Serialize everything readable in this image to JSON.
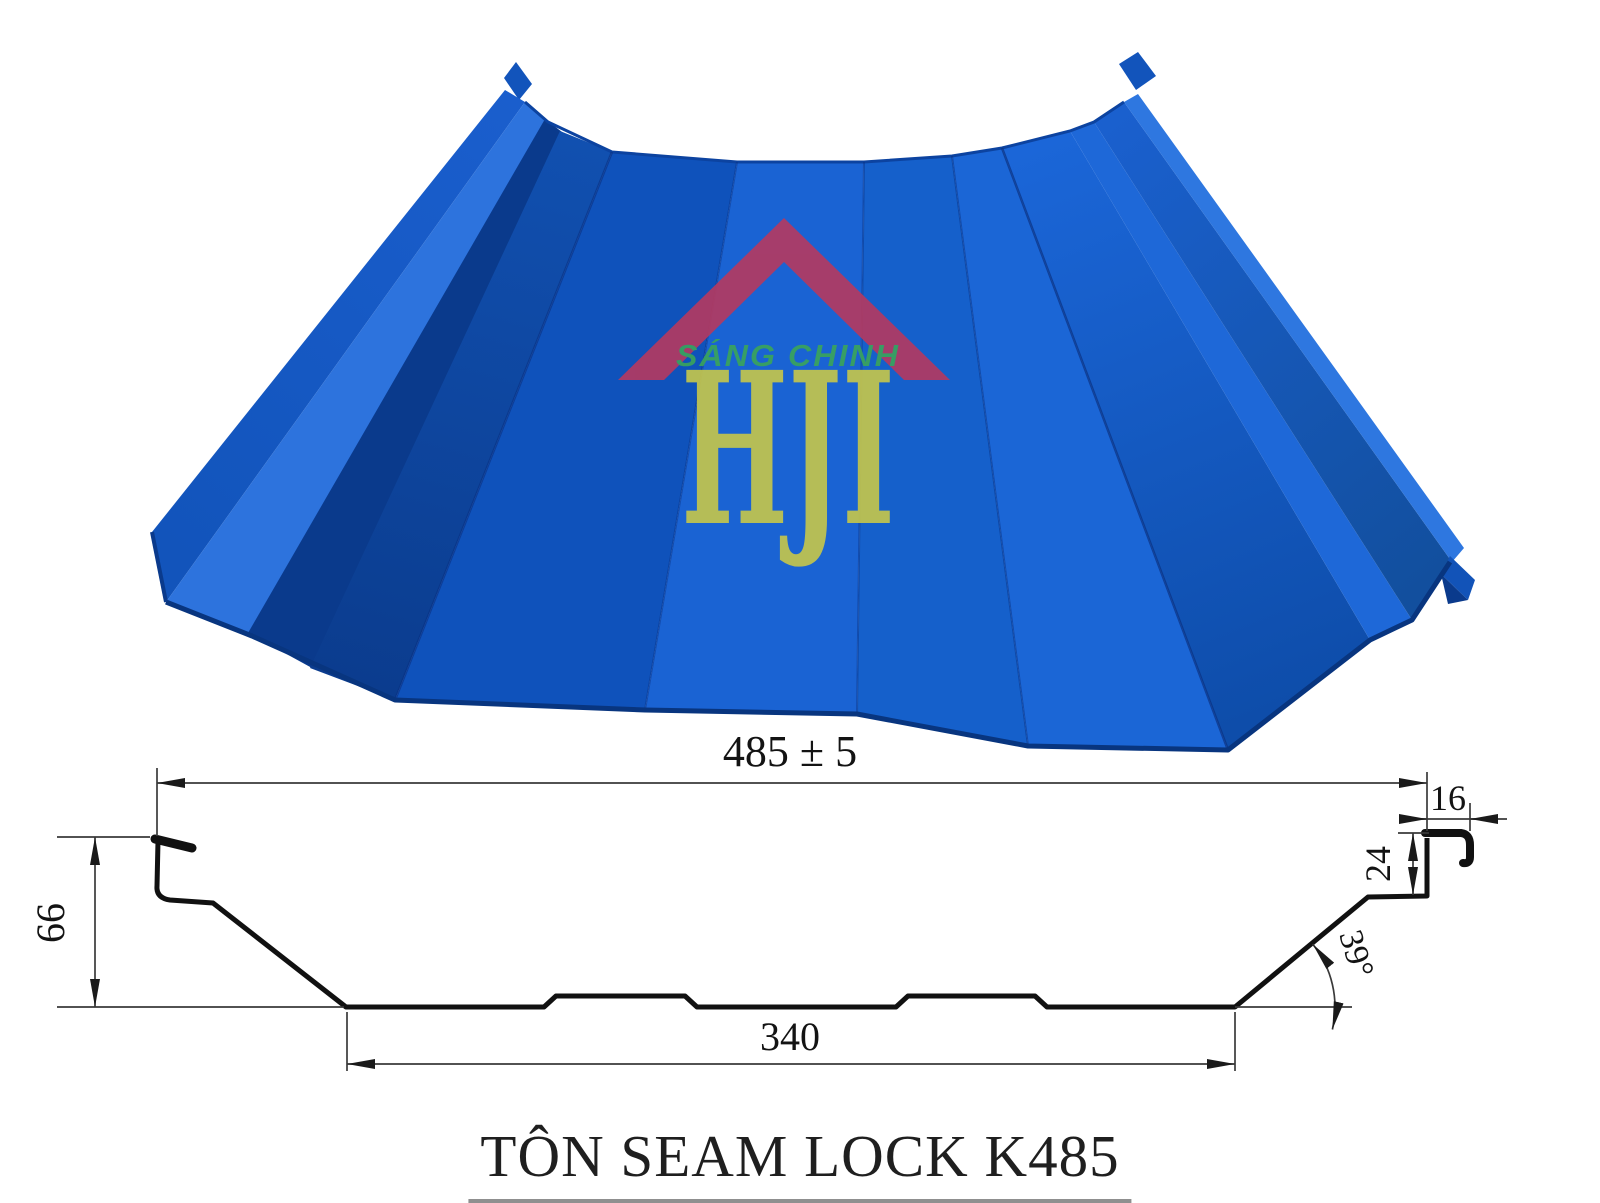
{
  "product": {
    "title": "TÔN SEAM LOCK K485",
    "type": "standing-seam roofing sheet"
  },
  "watermark": {
    "brand": "SÁNG CHINH",
    "monogram": "HJI",
    "roof_color": "#b23a62",
    "brand_color": "#3aa35c",
    "monogram_color": "#c3c54d"
  },
  "panel": {
    "color_main": "#1560cf",
    "color_shadow": "#0b3c8e",
    "color_highlight": "#2d73dd"
  },
  "drawing": {
    "line_color": "#1a1a1a",
    "dimensions": {
      "overall_width": "485 ± 5",
      "hook_width": "16",
      "rib_height": "24",
      "profile_height": "66",
      "base_width": "340",
      "web_angle": "39°"
    }
  }
}
